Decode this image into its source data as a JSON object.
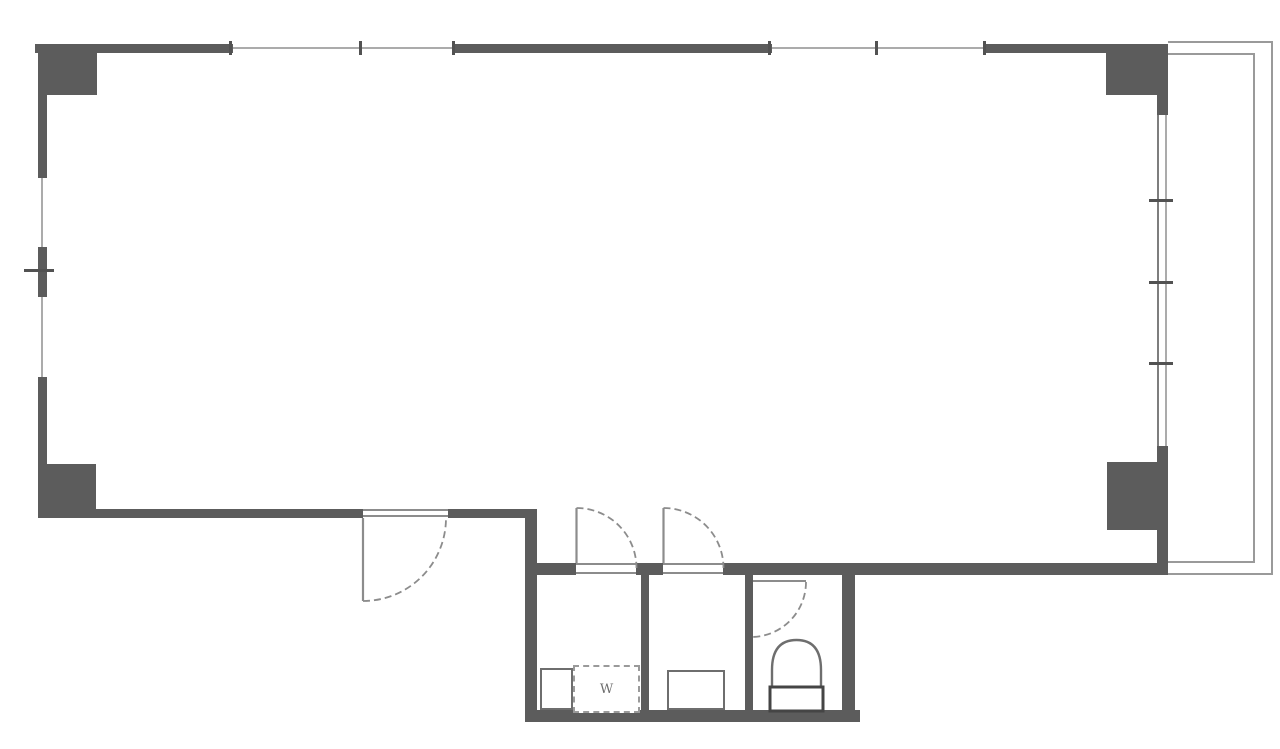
{
  "plan": {
    "labels": {
      "washer": "W"
    },
    "colors": {
      "background": "#ffffff",
      "wall": "#5c5c5c",
      "thin_line": "#8c8c8c",
      "glazing_line": "#ababab",
      "tick": "#525252",
      "fixture_line": "#6e6e6e",
      "toilet_tank_line": "#454545",
      "label_text": "#6e6e6e"
    }
  }
}
